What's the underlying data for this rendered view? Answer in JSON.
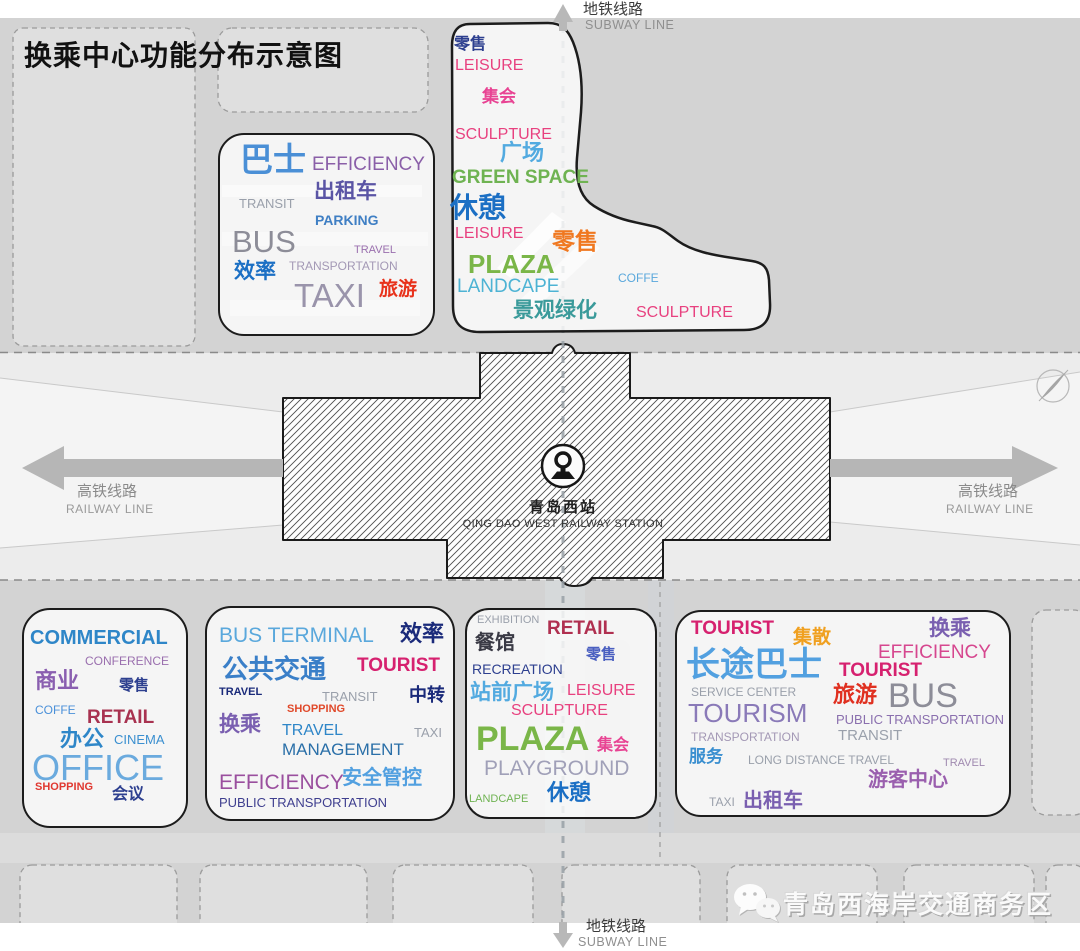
{
  "title": "换乘中心功能分布示意图",
  "palette": {
    "background": "#d3d3d3",
    "corridor": "#ececec",
    "parcel": "#dfdfdf",
    "cloud_outline": "#1c1c1c",
    "arrow_gray": "#b6b6b6"
  },
  "lines": {
    "subway_cn": "地铁线路",
    "subway_en": "SUBWAY LINE",
    "railway_cn": "高铁线路",
    "railway_en": "RAILWAY LINE"
  },
  "station": {
    "name_cn": "青岛西站",
    "name_en": "QING DAO WEST RAILWAY STATION"
  },
  "watermark": {
    "text": "青岛西海岸交通商务区"
  },
  "clouds": {
    "transit": {
      "words": [
        {
          "t": "巴士",
          "c": "#4a8fd6",
          "s": 33,
          "x": 20,
          "y": 8,
          "b": 1
        },
        {
          "t": "EFFICIENCY",
          "c": "#8a5fa8",
          "s": 19,
          "x": 92,
          "y": 20
        },
        {
          "t": "出租车",
          "c": "#5b55a5",
          "s": 21,
          "x": 94,
          "y": 46,
          "b": 1
        },
        {
          "t": "TRANSIT",
          "c": "#9aa0ab",
          "s": 13,
          "x": 19,
          "y": 62
        },
        {
          "t": "PARKING",
          "c": "#3f7fc4",
          "s": 14,
          "x": 95,
          "y": 78,
          "b": 1
        },
        {
          "t": "BUS",
          "c": "#8d8d98",
          "s": 31,
          "x": 12,
          "y": 91
        },
        {
          "t": "TRAVEL",
          "c": "#9a6fae",
          "s": 11,
          "x": 134,
          "y": 110
        },
        {
          "t": "效率",
          "c": "#1b6fc4",
          "s": 21,
          "x": 14,
          "y": 126,
          "b": 1
        },
        {
          "t": "TRANSPORTATION",
          "c": "#a398b5",
          "s": 12,
          "x": 69,
          "y": 125
        },
        {
          "t": "TAXI",
          "c": "#9a94ab",
          "s": 33,
          "x": 74,
          "y": 144
        },
        {
          "t": "旅游",
          "c": "#e8311a",
          "s": 19,
          "x": 159,
          "y": 145,
          "b": 1
        }
      ]
    },
    "plaza_north": {
      "words": [
        {
          "t": "零售",
          "c": "#2d3f8f",
          "s": 16,
          "x": 4,
          "y": 17,
          "b": 1
        },
        {
          "t": "LEISURE",
          "c": "#e8417f",
          "s": 16,
          "x": 5,
          "y": 38
        },
        {
          "t": "集会",
          "c": "#e84393",
          "s": 17,
          "x": 32,
          "y": 68,
          "b": 1
        },
        {
          "t": "SCULPTURE",
          "c": "#e8417f",
          "s": 16,
          "x": 5,
          "y": 107
        },
        {
          "t": "广场",
          "c": "#52aae0",
          "s": 22,
          "x": 50,
          "y": 122,
          "b": 1
        },
        {
          "t": "GREEN SPACE",
          "c": "#6fb352",
          "s": 19,
          "x": 2,
          "y": 148,
          "b": 1
        },
        {
          "t": "休憩",
          "c": "#1b6fc4",
          "s": 28,
          "x": 0,
          "y": 174,
          "b": 1
        },
        {
          "t": "LEISURE",
          "c": "#e8417f",
          "s": 16,
          "x": 5,
          "y": 206
        },
        {
          "t": "零售",
          "c": "#f07820",
          "s": 23,
          "x": 102,
          "y": 210,
          "b": 1
        },
        {
          "t": "PLAZA",
          "c": "#7ab648",
          "s": 26,
          "x": 18,
          "y": 231,
          "b": 1
        },
        {
          "t": "LANDCAPE",
          "c": "#4db3d4",
          "s": 19,
          "x": 7,
          "y": 257
        },
        {
          "t": "COFFE",
          "c": "#5aa8dc",
          "s": 12,
          "x": 168,
          "y": 252
        },
        {
          "t": "景观绿化",
          "c": "#3a9a9a",
          "s": 21,
          "x": 63,
          "y": 280,
          "b": 1
        },
        {
          "t": "SCULPTURE",
          "c": "#e8417f",
          "s": 16,
          "x": 186,
          "y": 285
        }
      ]
    },
    "commercial": {
      "words": [
        {
          "t": "COMMERCIAL",
          "c": "#2e86c8",
          "s": 20,
          "x": 6,
          "y": 18,
          "b": 1
        },
        {
          "t": "CONFERENCE",
          "c": "#9a6fae",
          "s": 12,
          "x": 61,
          "y": 45
        },
        {
          "t": "商业",
          "c": "#8a5fb0",
          "s": 22,
          "x": 11,
          "y": 60,
          "b": 1
        },
        {
          "t": "零售",
          "c": "#2d3f8f",
          "s": 15,
          "x": 95,
          "y": 68,
          "b": 1
        },
        {
          "t": "COFFE",
          "c": "#4a90d9",
          "s": 12,
          "x": 11,
          "y": 94
        },
        {
          "t": "RETAIL",
          "c": "#a83250",
          "s": 19,
          "x": 63,
          "y": 98,
          "b": 1
        },
        {
          "t": "办公",
          "c": "#2e86c8",
          "s": 22,
          "x": 36,
          "y": 118,
          "b": 1
        },
        {
          "t": "CINEMA",
          "c": "#3a8fd0",
          "s": 13,
          "x": 90,
          "y": 123
        },
        {
          "t": "OFFICE",
          "c": "#6aaade",
          "s": 36,
          "x": 8,
          "y": 140
        },
        {
          "t": "SHOPPING",
          "c": "#e03830",
          "s": 11,
          "x": 11,
          "y": 172,
          "b": 1
        },
        {
          "t": "会议",
          "c": "#2d3f8f",
          "s": 16,
          "x": 88,
          "y": 177,
          "b": 1
        }
      ]
    },
    "bus_terminal": {
      "words": [
        {
          "t": "BUS TERMINAL",
          "c": "#5aa8dc",
          "s": 21,
          "x": 12,
          "y": 17
        },
        {
          "t": "效率",
          "c": "#1a2a7a",
          "s": 22,
          "x": 193,
          "y": 15,
          "b": 1
        },
        {
          "t": "公共交通",
          "c": "#3a7fc8",
          "s": 26,
          "x": 15,
          "y": 48,
          "b": 1
        },
        {
          "t": "TOURIST",
          "c": "#d6216f",
          "s": 19,
          "x": 150,
          "y": 48,
          "b": 1
        },
        {
          "t": "TRAVEL",
          "c": "#1a2a7a",
          "s": 11,
          "x": 12,
          "y": 79,
          "b": 1
        },
        {
          "t": "TRANSIT",
          "c": "#9aa0ab",
          "s": 13,
          "x": 115,
          "y": 82
        },
        {
          "t": "中转",
          "c": "#1a2a7a",
          "s": 18,
          "x": 202,
          "y": 78,
          "b": 1
        },
        {
          "t": "SHOPPING",
          "c": "#e0492a",
          "s": 11,
          "x": 80,
          "y": 96,
          "b": 1
        },
        {
          "t": "换乘",
          "c": "#7a5fb0",
          "s": 21,
          "x": 12,
          "y": 106,
          "b": 1
        },
        {
          "t": "TRAVEL",
          "c": "#2e86c8",
          "s": 16,
          "x": 75,
          "y": 115
        },
        {
          "t": "MANAGEMENT",
          "c": "#2a6fa8",
          "s": 17,
          "x": 75,
          "y": 133
        },
        {
          "t": "TAXI",
          "c": "#9aa0ab",
          "s": 13,
          "x": 207,
          "y": 118
        },
        {
          "t": "EFFICIENCY",
          "c": "#9a4f9e",
          "s": 21,
          "x": 12,
          "y": 164
        },
        {
          "t": "安全管控",
          "c": "#52a0e0",
          "s": 20,
          "x": 135,
          "y": 160,
          "b": 1
        },
        {
          "t": "PUBLIC TRANSPORTATION",
          "c": "#3f3f8f",
          "s": 13,
          "x": 12,
          "y": 188
        }
      ]
    },
    "station_plaza": {
      "words": [
        {
          "t": "EXHIBITION",
          "c": "#9aa0ab",
          "s": 11,
          "x": 10,
          "y": 5
        },
        {
          "t": "RETAIL",
          "c": "#b03050",
          "s": 19,
          "x": 80,
          "y": 9,
          "b": 1
        },
        {
          "t": "餐馆",
          "c": "#3a3a45",
          "s": 20,
          "x": 8,
          "y": 23,
          "b": 1
        },
        {
          "t": "零售",
          "c": "#4a5fc0",
          "s": 15,
          "x": 119,
          "y": 37,
          "b": 1
        },
        {
          "t": "RECREATION",
          "c": "#2d3f8f",
          "s": 14,
          "x": 5,
          "y": 52
        },
        {
          "t": "站前广场",
          "c": "#52aae0",
          "s": 21,
          "x": 3,
          "y": 72,
          "b": 1
        },
        {
          "t": "LEISURE",
          "c": "#e8417f",
          "s": 16,
          "x": 100,
          "y": 73
        },
        {
          "t": "SCULPTURE",
          "c": "#e8417f",
          "s": 16,
          "x": 44,
          "y": 93
        },
        {
          "t": "PLAZA",
          "c": "#7ab648",
          "s": 34,
          "x": 9,
          "y": 112,
          "b": 1
        },
        {
          "t": "集会",
          "c": "#e84393",
          "s": 16,
          "x": 130,
          "y": 128,
          "b": 1
        },
        {
          "t": "PLAYGROUND",
          "c": "#a0a0b8",
          "s": 21,
          "x": 17,
          "y": 148
        },
        {
          "t": "LANDCAPE",
          "c": "#6fb352",
          "s": 11,
          "x": 2,
          "y": 184
        },
        {
          "t": "休憩",
          "c": "#1b6fc4",
          "s": 22,
          "x": 80,
          "y": 172,
          "b": 1
        }
      ]
    },
    "long_distance": {
      "words": [
        {
          "t": "TOURIST",
          "c": "#d6216f",
          "s": 19,
          "x": 14,
          "y": 7,
          "b": 1
        },
        {
          "t": "集散",
          "c": "#f0a020",
          "s": 19,
          "x": 116,
          "y": 16,
          "b": 1
        },
        {
          "t": "换乘",
          "c": "#7a5fb0",
          "s": 21,
          "x": 252,
          "y": 6,
          "b": 1
        },
        {
          "t": "EFFICIENCY",
          "c": "#d6478f",
          "s": 19,
          "x": 201,
          "y": 31
        },
        {
          "t": "长途巴士",
          "c": "#52a0e0",
          "s": 34,
          "x": 9,
          "y": 36,
          "b": 1
        },
        {
          "t": "TOURIST",
          "c": "#d6216f",
          "s": 19,
          "x": 162,
          "y": 49,
          "b": 1
        },
        {
          "t": "SERVICE CENTER",
          "c": "#9aa0ab",
          "s": 12,
          "x": 14,
          "y": 74
        },
        {
          "t": "旅游",
          "c": "#e03020",
          "s": 22,
          "x": 156,
          "y": 72,
          "b": 1
        },
        {
          "t": "BUS",
          "c": "#8d8d98",
          "s": 34,
          "x": 211,
          "y": 67
        },
        {
          "t": "TOURISM",
          "c": "#8a7ab8",
          "s": 26,
          "x": 11,
          "y": 88
        },
        {
          "t": "PUBLIC TRANSPORTATION",
          "c": "#8a6fae",
          "s": 13,
          "x": 159,
          "y": 101
        },
        {
          "t": "TRANSPORTATION",
          "c": "#a398b5",
          "s": 12,
          "x": 14,
          "y": 119
        },
        {
          "t": "TRANSIT",
          "c": "#9aa0ab",
          "s": 15,
          "x": 161,
          "y": 116
        },
        {
          "t": "服务",
          "c": "#3a8fd0",
          "s": 17,
          "x": 12,
          "y": 136,
          "b": 1
        },
        {
          "t": "LONG DISTANCE TRAVEL",
          "c": "#9aa0ab",
          "s": 12,
          "x": 71,
          "y": 142
        },
        {
          "t": "TRAVEL",
          "c": "#a08ab0",
          "s": 11,
          "x": 266,
          "y": 146
        },
        {
          "t": "游客中心",
          "c": "#9a5fae",
          "s": 20,
          "x": 191,
          "y": 158,
          "b": 1
        },
        {
          "t": "TAXI",
          "c": "#9aa0ab",
          "s": 12,
          "x": 32,
          "y": 184
        },
        {
          "t": "出租车",
          "c": "#7a5fb0",
          "s": 20,
          "x": 66,
          "y": 179,
          "b": 1
        }
      ]
    }
  }
}
